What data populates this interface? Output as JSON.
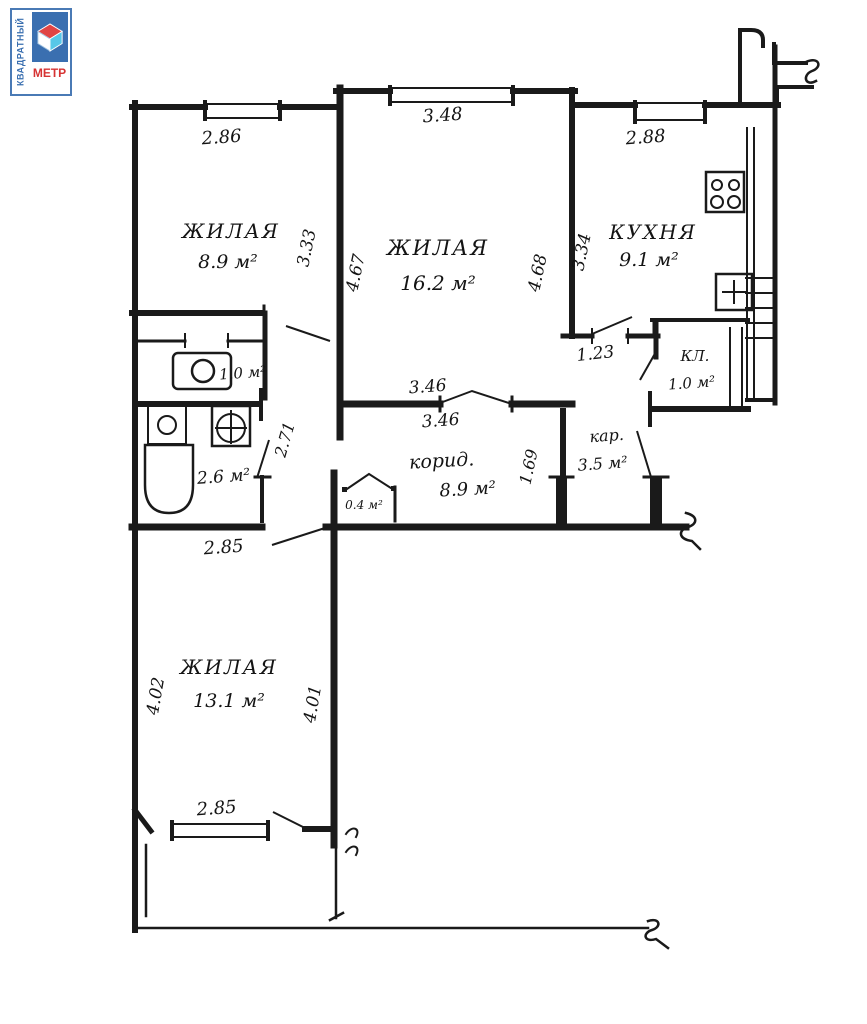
{
  "logo": {
    "vertical_text": "КВАДРАТНЫЙ",
    "bottom_text": "МЕТР",
    "blue": "#3a6fb0",
    "red": "#d63333",
    "cube_top": "#e04444",
    "cube_left": "#ffffff",
    "cube_right": "#57c7e8"
  },
  "rooms": {
    "living1": {
      "name": "ЖИЛАЯ",
      "area": "8.9 м²"
    },
    "living2": {
      "name": "ЖИЛАЯ",
      "area": "16.2 м²"
    },
    "kitchen": {
      "name": "КУХНЯ",
      "area": "9.1 м²"
    },
    "toilet": {
      "area": "1.0 м²"
    },
    "bath": {
      "area": "2.6 м²"
    },
    "closet": {
      "name": "КЛ.",
      "area": "1.0 м²"
    },
    "corridor": {
      "name": "корид.",
      "area": "8.9 м²"
    },
    "pantry": {
      "area": "0.4 м²"
    },
    "hall": {
      "name": "кар.",
      "area": "3.5 м²"
    },
    "living3": {
      "name": "ЖИЛАЯ",
      "area": "13.1 м²"
    }
  },
  "dimensions": {
    "top_left": "2.86",
    "top_center": "3.48",
    "top_right": "2.88",
    "left_room_side": "3.33",
    "center_left": "4.67",
    "center_right": "4.68",
    "kitchen_side": "3.34",
    "kitchen_door": "1.23",
    "passage": "2.71",
    "center_door_top": "3.46",
    "center_door_bottom": "3.46",
    "hall_side": "1.69",
    "mid_wall": "2.85",
    "bottom_left_side": "4.02",
    "bottom_right_side": "4.01",
    "bottom_window": "2.85"
  }
}
